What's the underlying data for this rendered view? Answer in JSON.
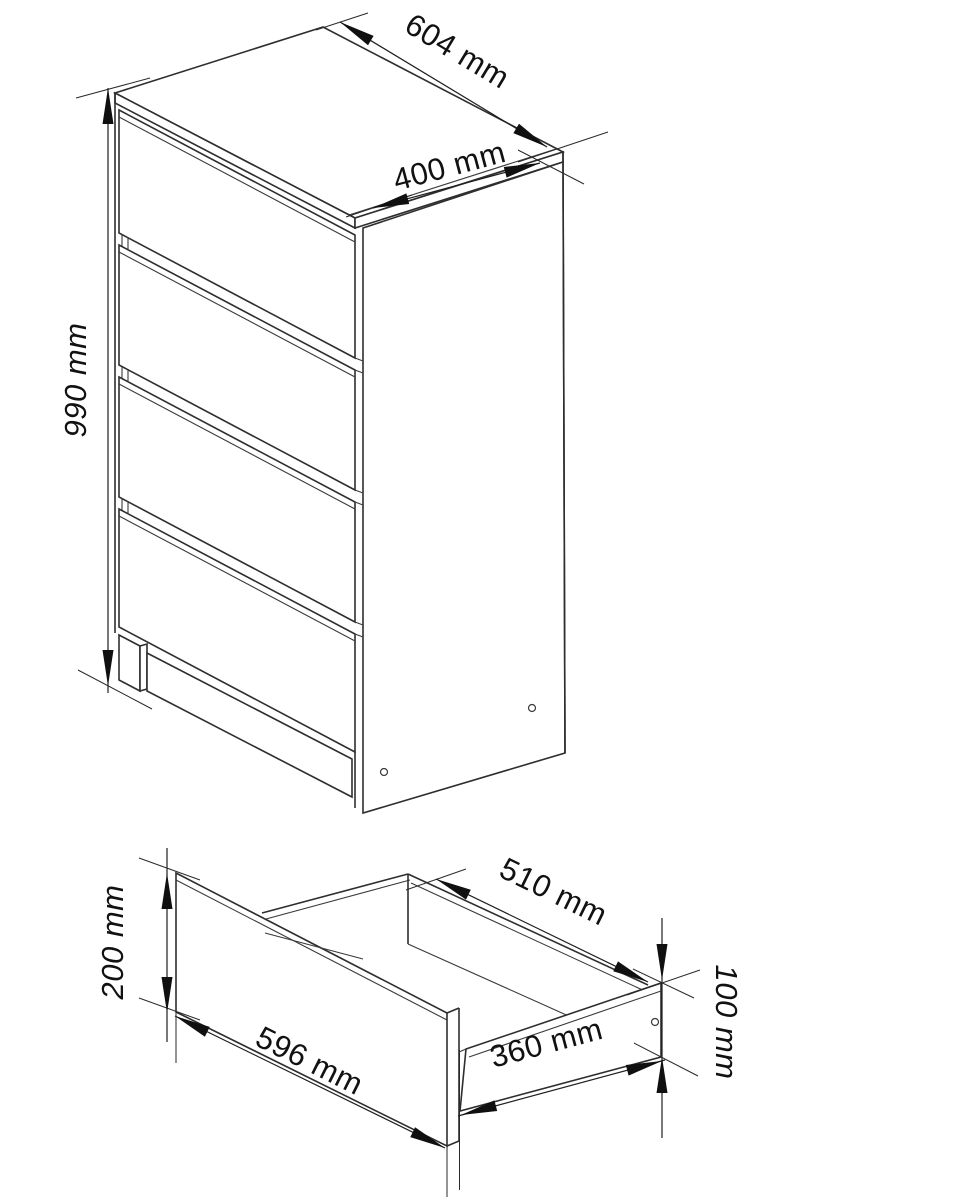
{
  "drawing": {
    "cabinet": {
      "width_label": "604 mm",
      "depth_label": "400 mm",
      "height_label": "990 mm"
    },
    "drawer": {
      "front_height_label": "200 mm",
      "front_width_label": "596 mm",
      "inner_width_label": "510 mm",
      "side_length_label": "360 mm",
      "side_height_label": "100 mm"
    },
    "colors": {
      "line": "#2e2e2e",
      "dimension": "#1f1f1f",
      "text": "#111111",
      "background": "#ffffff"
    }
  }
}
